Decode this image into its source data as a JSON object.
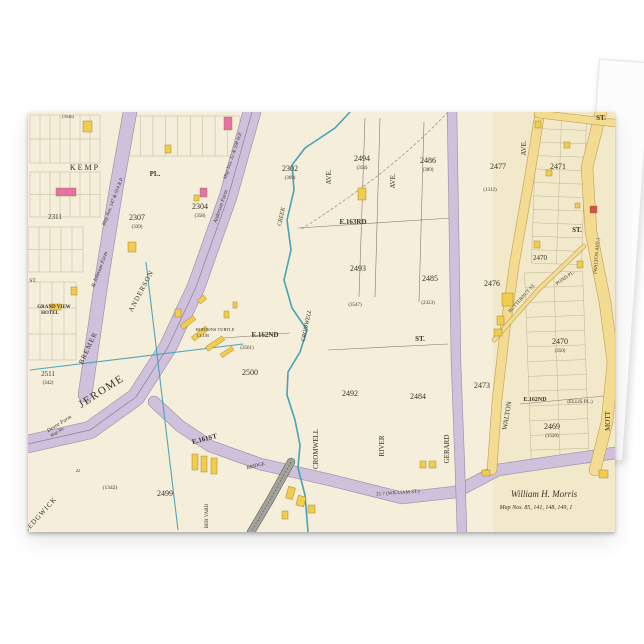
{
  "product": {
    "item_kind_label": "",
    "accent_colors": {
      "backdrop": "#ffffff",
      "card_face": "#f4eeda"
    }
  },
  "map": {
    "colors": {
      "cream": "#f4eeda",
      "cream2": "#efdfb6",
      "lilac": "#cfc0dc",
      "lilacEdge": "#93869e",
      "yellow": "#f3dc92",
      "yellowEdge": "#bb9c4e",
      "rail": "#a3a39e",
      "railEdge": "#5d5d58",
      "teal": "#3f9db5",
      "ink": "#3b3328",
      "parcel": "#8b7b5a",
      "pink": "#e671a8",
      "red": "#d0504c",
      "bldgYellow": "#f2cc4e",
      "bldgEdge": "#96791c"
    },
    "grids": [
      {
        "x": 2,
        "y": 3,
        "w": 70,
        "h": 48,
        "cols": 7,
        "rows": 2,
        "r": 0
      },
      {
        "x": 2,
        "y": 60,
        "w": 70,
        "h": 45,
        "cols": 7,
        "rows": 2,
        "r": 0
      },
      {
        "x": 0,
        "y": 115,
        "w": 55,
        "h": 45,
        "cols": 5,
        "rows": 2,
        "r": 0
      },
      {
        "x": 0,
        "y": 170,
        "w": 48,
        "h": 78,
        "cols": 4,
        "rows": 3,
        "r": 0
      },
      {
        "x": 506,
        "y": 4,
        "w": 50,
        "h": 148,
        "cols": 2,
        "rows": 11,
        "r": 2
      },
      {
        "x": 500,
        "y": 160,
        "w": 58,
        "h": 192,
        "cols": 2,
        "rows": 13,
        "r": -2
      },
      {
        "x": 100,
        "y": 4,
        "w": 112,
        "h": 40,
        "cols": 9,
        "rows": 1,
        "r": 0
      }
    ],
    "blackLines": [
      "270,116 424,106",
      "196,226 262,221",
      "492,292 587,283",
      "337,6 331,185",
      "352,6 347,185",
      "396,10 391,190",
      "300,238 420,232"
    ],
    "dashed": [
      "M420,0 C375,48 322,86 272,118"
    ],
    "bands": [
      {
        "p": "102,0 88,78 74,165 57,283",
        "w": 13,
        "c": "lilac"
      },
      {
        "p": "224,0 200,85 168,175 140,235 108,285 62,318 0,332",
        "w": 17,
        "c": "lilac"
      },
      {
        "p": "126,290 152,314 182,334 232,352 302,368 374,386 428,380 470,358 524,350 587,341",
        "w": 11,
        "c": "lilac"
      },
      {
        "p": "424,0 426,120 428,250 432,358 434,420",
        "w": 9,
        "c": "lilac"
      },
      {
        "p": "512,0 501,68 487,148 477,218 469,288 464,358",
        "w": 9,
        "c": "yellow"
      },
      {
        "p": "573,0 559,55 563,120 577,190 585,250 579,310 567,358",
        "w": 11,
        "c": "yellow"
      },
      {
        "p": "510,2 586,11",
        "w": 7,
        "c": "yellow"
      },
      {
        "p": "466,228 510,178 556,134",
        "w": 3.5,
        "c": "yellow"
      },
      {
        "p": "263,350 242,388 223,420",
        "w": 7,
        "c": "rail"
      }
    ],
    "creek": "322,0 307,16 277,36 264,53 266,78 259,108 263,138 256,168 264,196 279,218 272,240 260,260 259,283 267,308 272,333 270,356 277,383 280,420",
    "tealLines": [
      "2,258 215,232",
      "118,150 150,418"
    ],
    "buildings": [
      {
        "x": 28,
        "y": 76,
        "w": 20,
        "h": 8,
        "c": "P"
      },
      {
        "x": 196,
        "y": 5,
        "w": 8,
        "h": 13,
        "c": "P"
      },
      {
        "x": 172,
        "y": 76,
        "w": 7,
        "h": 9,
        "c": "P"
      },
      {
        "x": 166,
        "y": 83,
        "w": 5,
        "h": 6,
        "c": "Y"
      },
      {
        "x": 562,
        "y": 94,
        "w": 7,
        "h": 7,
        "c": "R"
      },
      {
        "x": 55,
        "y": 9,
        "w": 9,
        "h": 11,
        "c": "Y"
      },
      {
        "x": 137,
        "y": 33,
        "w": 6,
        "h": 8,
        "c": "Y"
      },
      {
        "x": 100,
        "y": 130,
        "w": 8,
        "h": 10,
        "c": "Y"
      },
      {
        "x": 43,
        "y": 175,
        "w": 6,
        "h": 8,
        "c": "Y"
      },
      {
        "x": 22,
        "y": 192,
        "w": 11,
        "h": 6,
        "c": "Y"
      },
      {
        "x": 330,
        "y": 76,
        "w": 8,
        "h": 12,
        "c": "Y"
      },
      {
        "x": 474,
        "y": 181,
        "w": 11,
        "h": 13,
        "c": "Y"
      },
      {
        "x": 469,
        "y": 204,
        "w": 7,
        "h": 9,
        "c": "Y"
      },
      {
        "x": 466,
        "y": 217,
        "w": 8,
        "h": 7,
        "c": "Y"
      },
      {
        "x": 507,
        "y": 9,
        "w": 6,
        "h": 7,
        "c": "Y"
      },
      {
        "x": 536,
        "y": 30,
        "w": 6,
        "h": 6,
        "c": "Y"
      },
      {
        "x": 518,
        "y": 58,
        "w": 6,
        "h": 6,
        "c": "Y"
      },
      {
        "x": 547,
        "y": 91,
        "w": 5,
        "h": 5,
        "c": "Y"
      },
      {
        "x": 506,
        "y": 129,
        "w": 6,
        "h": 7,
        "c": "Y"
      },
      {
        "x": 549,
        "y": 149,
        "w": 6,
        "h": 7,
        "c": "Y"
      },
      {
        "x": 164,
        "y": 342,
        "w": 6,
        "h": 16,
        "c": "Y"
      },
      {
        "x": 173,
        "y": 344,
        "w": 6,
        "h": 16,
        "c": "Y"
      },
      {
        "x": 183,
        "y": 346,
        "w": 6,
        "h": 16,
        "c": "Y"
      },
      {
        "x": 259,
        "y": 375,
        "w": 7,
        "h": 12,
        "c": "Y",
        "r": 15
      },
      {
        "x": 269,
        "y": 384,
        "w": 8,
        "h": 10,
        "c": "Y",
        "r": 15
      },
      {
        "x": 280,
        "y": 393,
        "w": 7,
        "h": 8,
        "c": "Y"
      },
      {
        "x": 254,
        "y": 399,
        "w": 6,
        "h": 8,
        "c": "Y"
      },
      {
        "x": 392,
        "y": 349,
        "w": 6,
        "h": 7,
        "c": "Y"
      },
      {
        "x": 401,
        "y": 349,
        "w": 7,
        "h": 7,
        "c": "Y"
      },
      {
        "x": 454,
        "y": 358,
        "w": 8,
        "h": 6,
        "c": "Y"
      },
      {
        "x": 571,
        "y": 358,
        "w": 9,
        "h": 8,
        "c": "Y"
      },
      {
        "x": 152,
        "y": 208,
        "w": 16,
        "h": 5,
        "c": "Y",
        "r": -38
      },
      {
        "x": 163,
        "y": 219,
        "w": 18,
        "h": 5,
        "c": "Y",
        "r": -38
      },
      {
        "x": 177,
        "y": 229,
        "w": 20,
        "h": 5,
        "c": "Y",
        "r": -34
      },
      {
        "x": 192,
        "y": 238,
        "w": 14,
        "h": 4,
        "c": "Y",
        "r": -34
      },
      {
        "x": 147,
        "y": 197,
        "w": 6,
        "h": 8,
        "c": "Y"
      },
      {
        "x": 196,
        "y": 199,
        "w": 5,
        "h": 7,
        "c": "Y"
      },
      {
        "x": 205,
        "y": 190,
        "w": 4,
        "h": 6,
        "c": "Y"
      },
      {
        "x": 170,
        "y": 185,
        "w": 8,
        "h": 5,
        "c": "Y",
        "r": -38
      }
    ],
    "labels": [
      {
        "t": "KEMP",
        "x": 57,
        "y": 58,
        "s": 8,
        "ls": 2
      },
      {
        "t": "PL.",
        "x": 127,
        "y": 64,
        "s": 7,
        "b": 1
      },
      {
        "t": "2307",
        "x": 109,
        "y": 108,
        "s": 8
      },
      {
        "t": "(339)",
        "x": 109,
        "y": 116,
        "s": 5
      },
      {
        "t": "2304",
        "x": 172,
        "y": 97,
        "s": 8
      },
      {
        "t": "(358)",
        "x": 172,
        "y": 105,
        "s": 5
      },
      {
        "t": "2302",
        "x": 262,
        "y": 59,
        "s": 8
      },
      {
        "t": "(369)",
        "x": 262,
        "y": 67,
        "s": 5
      },
      {
        "t": "2494",
        "x": 334,
        "y": 49,
        "s": 8
      },
      {
        "t": "(354)",
        "x": 334,
        "y": 57,
        "s": 5
      },
      {
        "t": "2486",
        "x": 400,
        "y": 51,
        "s": 8
      },
      {
        "t": "(389)",
        "x": 400,
        "y": 59,
        "s": 5
      },
      {
        "t": "2477",
        "x": 470,
        "y": 57,
        "s": 8
      },
      {
        "t": "(1312)",
        "x": 462,
        "y": 79,
        "s": 5
      },
      {
        "t": "2471",
        "x": 530,
        "y": 57,
        "s": 8
      },
      {
        "t": "E.163RD",
        "x": 325,
        "y": 112,
        "s": 7,
        "b": 1
      },
      {
        "t": "2493",
        "x": 330,
        "y": 159,
        "s": 8
      },
      {
        "t": "2485",
        "x": 402,
        "y": 169,
        "s": 8
      },
      {
        "t": "2476",
        "x": 464,
        "y": 174,
        "s": 8
      },
      {
        "t": "2470",
        "x": 512,
        "y": 148,
        "s": 7
      },
      {
        "t": "2470",
        "x": 532,
        "y": 232,
        "s": 8
      },
      {
        "t": "(350)",
        "x": 532,
        "y": 240,
        "s": 5
      },
      {
        "t": "ST.",
        "x": 549,
        "y": 120,
        "s": 7,
        "b": 1
      },
      {
        "t": "ST.",
        "x": 573,
        "y": 8,
        "s": 7,
        "b": 1
      },
      {
        "t": "AVE.",
        "x": 303,
        "y": 65,
        "s": 7,
        "r": -90
      },
      {
        "t": "AVE.",
        "x": 367,
        "y": 69,
        "s": 7,
        "r": -90
      },
      {
        "t": "AVE.",
        "x": 498,
        "y": 36,
        "s": 7,
        "r": -90
      },
      {
        "t": "CROMWELL",
        "x": 290,
        "y": 337,
        "s": 7,
        "r": -90
      },
      {
        "t": "RIVER",
        "x": 356,
        "y": 334,
        "s": 7,
        "r": -90
      },
      {
        "t": "GERARD",
        "x": 421,
        "y": 337,
        "s": 7,
        "r": -90
      },
      {
        "t": "WALTON",
        "x": 481,
        "y": 304,
        "s": 7,
        "r": -80
      },
      {
        "t": "MOTT",
        "x": 582,
        "y": 309,
        "s": 7,
        "r": -90
      },
      {
        "t": "(WALTON AVE.)",
        "x": 570,
        "y": 144,
        "s": 5,
        "r": -85
      },
      {
        "t": "BUTTERNUT ST.",
        "x": 495,
        "y": 187,
        "s": 5,
        "r": -48
      },
      {
        "t": "POND PL.",
        "x": 538,
        "y": 167,
        "s": 5,
        "r": -35
      },
      {
        "t": "E.162ND",
        "x": 237,
        "y": 225,
        "s": 7,
        "b": 1
      },
      {
        "t": "(3561)",
        "x": 219,
        "y": 237,
        "s": 5
      },
      {
        "t": "HORTONS TURTLE",
        "x": 187,
        "y": 219,
        "s": 4.5
      },
      {
        "t": "CLUB",
        "x": 175,
        "y": 225,
        "s": 4.5
      },
      {
        "t": "2500",
        "x": 222,
        "y": 263,
        "s": 8
      },
      {
        "t": "CREEK",
        "x": 255,
        "y": 105,
        "s": 6,
        "r": -78,
        "i": 1
      },
      {
        "t": "CROMWELL",
        "x": 280,
        "y": 214,
        "s": 6,
        "r": -78,
        "i": 1
      },
      {
        "t": "(3547)",
        "x": 327,
        "y": 194,
        "s": 5
      },
      {
        "t": "(2323)",
        "x": 400,
        "y": 192,
        "s": 5
      },
      {
        "t": "ST.",
        "x": 392,
        "y": 229,
        "s": 7,
        "b": 1
      },
      {
        "t": "2492",
        "x": 322,
        "y": 284,
        "s": 8
      },
      {
        "t": "2484",
        "x": 390,
        "y": 287,
        "s": 8
      },
      {
        "t": "2473",
        "x": 454,
        "y": 276,
        "s": 8
      },
      {
        "t": "E.162ND",
        "x": 507,
        "y": 289,
        "s": 6,
        "b": 1
      },
      {
        "t": "(ELLIS PL.)",
        "x": 552,
        "y": 291,
        "s": 5
      },
      {
        "t": "2469",
        "x": 524,
        "y": 317,
        "s": 8
      },
      {
        "t": "(1520)",
        "x": 524,
        "y": 325,
        "s": 5
      },
      {
        "t": "E.161ST",
        "x": 177,
        "y": 329,
        "s": 7,
        "b": 1,
        "r": -14
      },
      {
        "t": "BRIDGE",
        "x": 228,
        "y": 355,
        "s": 5,
        "r": -14
      },
      {
        "t": "21.7 (WILLIAM ST.)",
        "x": 370,
        "y": 382,
        "s": 5,
        "r": -4
      },
      {
        "t": "William H. Morris",
        "x": 516,
        "y": 385,
        "s": 9,
        "i": 1
      },
      {
        "t": "Map Nos. 85, 141, 148, 149, 1",
        "x": 508,
        "y": 397,
        "s": 6,
        "i": 1
      },
      {
        "t": "JEROME",
        "x": 75,
        "y": 282,
        "s": 11,
        "r": -33,
        "ls": 1.5
      },
      {
        "t": "BREMER",
        "x": 62,
        "y": 237,
        "s": 7,
        "r": -65,
        "ls": 1
      },
      {
        "t": "ANDERSON",
        "x": 115,
        "y": 180,
        "s": 7,
        "r": -62,
        "ls": 1
      },
      {
        "t": "& Johnson Farm",
        "x": 73,
        "y": 158,
        "s": 5.5,
        "r": -69,
        "i": 1
      },
      {
        "t": "Map Nos. 147 & 914 R.P.",
        "x": 86,
        "y": 90,
        "s": 5,
        "r": -69,
        "i": 1
      },
      {
        "t": "Anderson Farm",
        "x": 194,
        "y": 95,
        "s": 5.5,
        "r": -71,
        "i": 1
      },
      {
        "t": "Map Nos. 32 & 598 W.P.",
        "x": 206,
        "y": 44,
        "s": 5,
        "r": -71,
        "i": 1
      },
      {
        "t": "Devoe Farm",
        "x": 32,
        "y": 313,
        "s": 5.5,
        "r": -32,
        "i": 1
      },
      {
        "t": "Map No.",
        "x": 30,
        "y": 321,
        "s": 4.5,
        "r": -32,
        "i": 1
      },
      {
        "t": "SEDGWICK",
        "x": 14,
        "y": 404,
        "s": 7,
        "r": -48,
        "ls": 1
      },
      {
        "t": "BER YARD",
        "x": 180,
        "y": 404,
        "s": 5,
        "r": -90
      },
      {
        "t": "2499",
        "x": 137,
        "y": 384,
        "s": 8
      },
      {
        "t": "(1342)",
        "x": 82,
        "y": 377,
        "s": 5.5
      },
      {
        "t": "22",
        "x": 50,
        "y": 360,
        "s": 4.5,
        "i": 1
      },
      {
        "t": "2511",
        "x": 20,
        "y": 264,
        "s": 7
      },
      {
        "t": "(342)",
        "x": 20,
        "y": 272,
        "s": 5
      },
      {
        "t": "2311",
        "x": 27,
        "y": 107,
        "s": 7
      },
      {
        "t": "(3546)",
        "x": 40,
        "y": 6,
        "s": 4.5
      },
      {
        "t": "GRAND VIEW",
        "x": 26,
        "y": 196,
        "s": 5,
        "b": 1
      },
      {
        "t": "HOTEL",
        "x": 22,
        "y": 202,
        "s": 5,
        "b": 1
      },
      {
        "t": "ST.",
        "x": 5,
        "y": 170,
        "s": 5.5
      }
    ]
  }
}
